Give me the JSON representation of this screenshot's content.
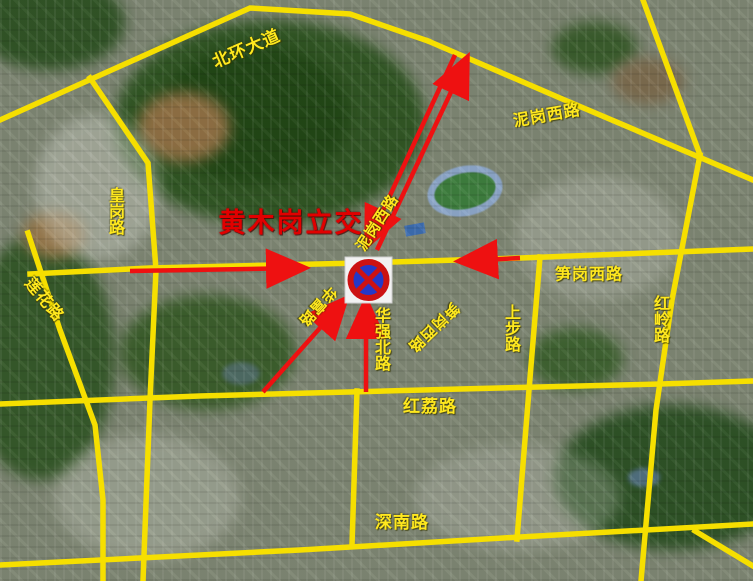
{
  "map": {
    "interchange_title": "黄木岗立交",
    "labels": {
      "beihuan": "北环大道",
      "nigang_top": "泥岗西路",
      "huanggang": "皇岗路",
      "lianhua": "莲花路",
      "nigang_diag": "泥岗西路",
      "sungang_main": "笋岗西路",
      "hongling": "红岭路",
      "huaqiangbei": "华强北路",
      "sungang_diag": "笋岗西路",
      "shangbu": "上步路",
      "hongli": "红荔路",
      "shennan": "深南路",
      "huafu": "华富路"
    },
    "sign": {
      "name": "no-stopping-sign",
      "description": "blue circle, red ring, red diagonal cross on white square"
    },
    "colors": {
      "road_highlight": "#f6df00",
      "route_overlay": "#ee1111",
      "label_text": "#ffe81e",
      "title_text": "#e10000"
    }
  }
}
